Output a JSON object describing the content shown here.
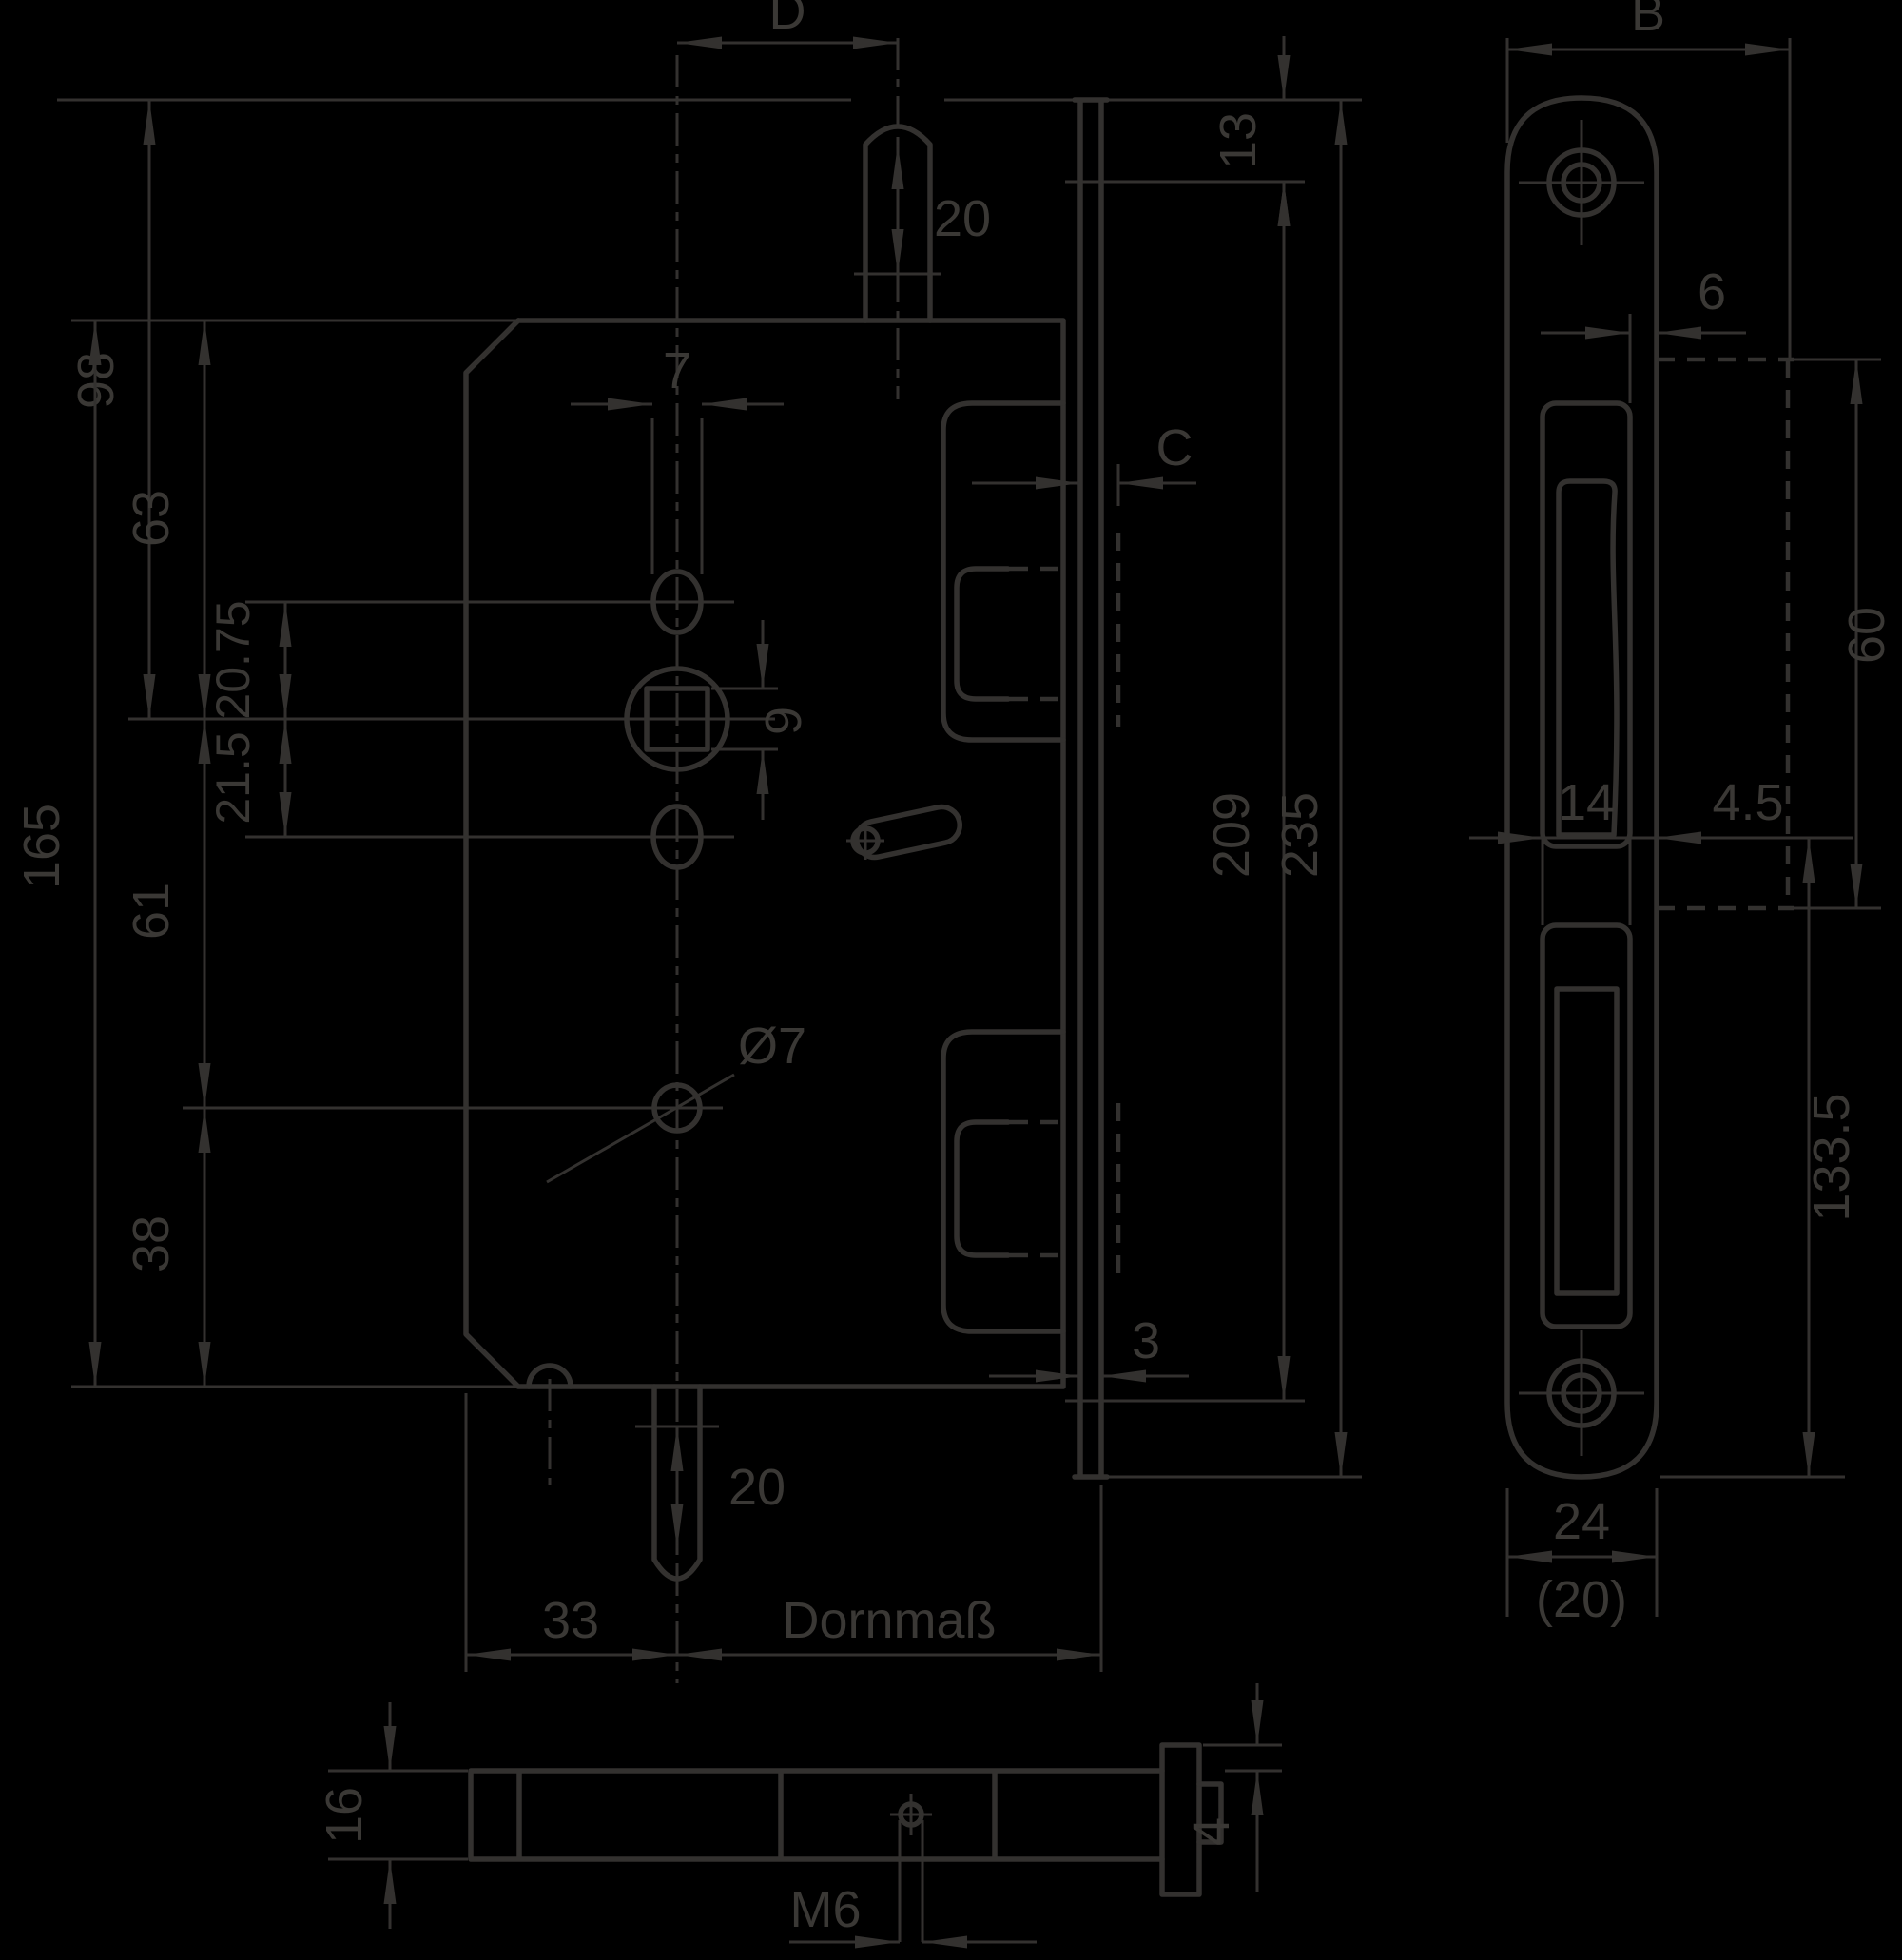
{
  "title": "Einsteckschloss Masszeichnung (mortise lock dimension drawing)",
  "colors": {
    "background": "#000000",
    "line": "#33312f",
    "text": "#3a3835"
  },
  "front": {
    "d_D": "D",
    "d_20_top": "20",
    "d_13": "13",
    "d_C": "C",
    "d_98": "98",
    "d_63": "63",
    "d_7": "7",
    "d_2075": "20.75",
    "d_215": "21.5",
    "d_9": "9",
    "d_165": "165",
    "d_61": "61",
    "d_dia7": "Ø7",
    "d_38": "38",
    "d_209": "209",
    "d_235": "235",
    "d_3": "3",
    "d_20_bottom": "20",
    "d_33": "33",
    "d_dornmass": "Dornmaß"
  },
  "plate": {
    "d_B": "B",
    "d_6": "6",
    "d_60": "60",
    "d_14": "14",
    "d_45": "4.5",
    "d_1335": "133.5",
    "d_24": "24",
    "d_20_alt": "(20)"
  },
  "top": {
    "d_16": "16",
    "d_M6": "M6",
    "d_4": "4"
  }
}
